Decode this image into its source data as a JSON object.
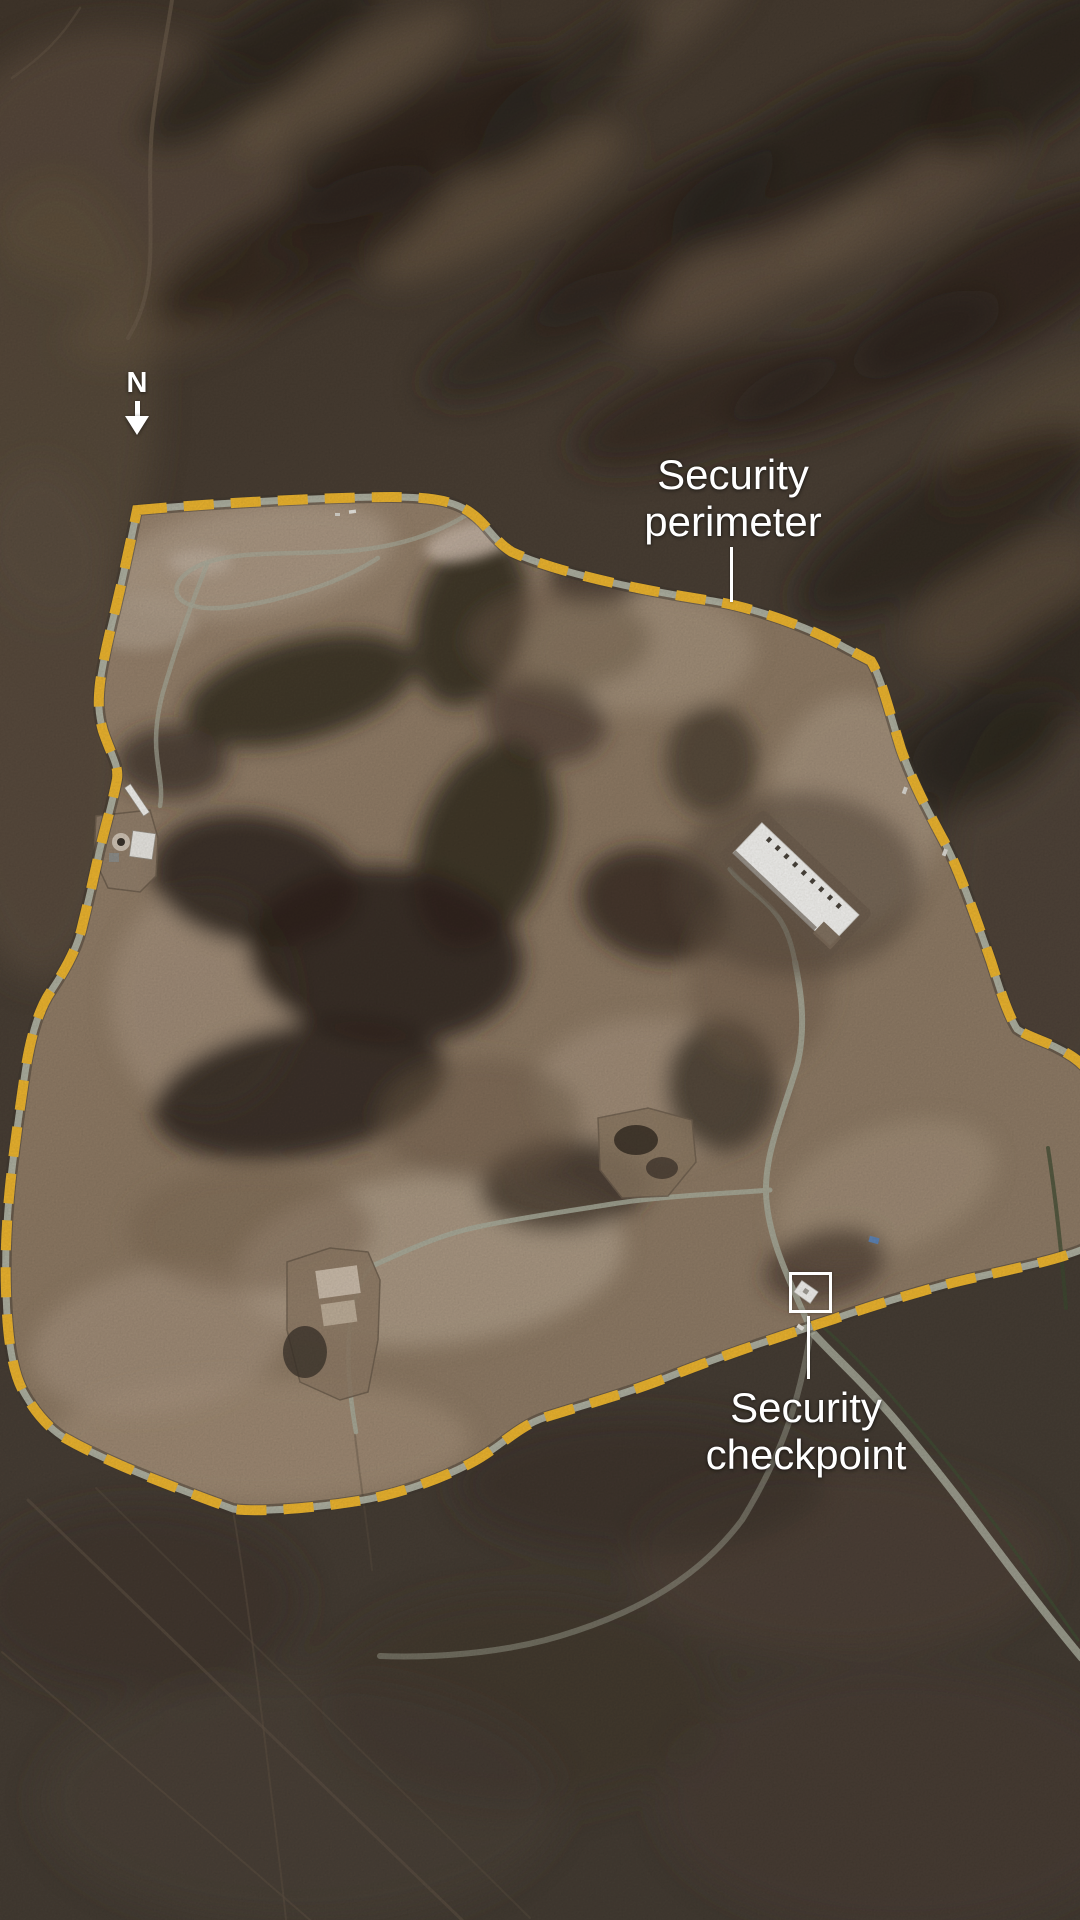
{
  "north_indicator": {
    "label": "N",
    "icon": "north-arrow-down-icon"
  },
  "labels": {
    "security_perimeter": {
      "line1": "Security",
      "line2": "perimeter"
    },
    "security_checkpoint": {
      "line1": "Security",
      "line2": "checkpoint"
    }
  },
  "map_features": {
    "perimeter_marker_style": "yellow dashed line",
    "checkpoint_marker_style": "white outline square"
  },
  "colors": {
    "perimeter_dash": "#EDB52F",
    "perimeter_road": "#B2B5A5",
    "annotation_text": "#FFFFFF",
    "leader_line": "#FFFFFF",
    "checkpoint_box": "#FFFFFF"
  }
}
